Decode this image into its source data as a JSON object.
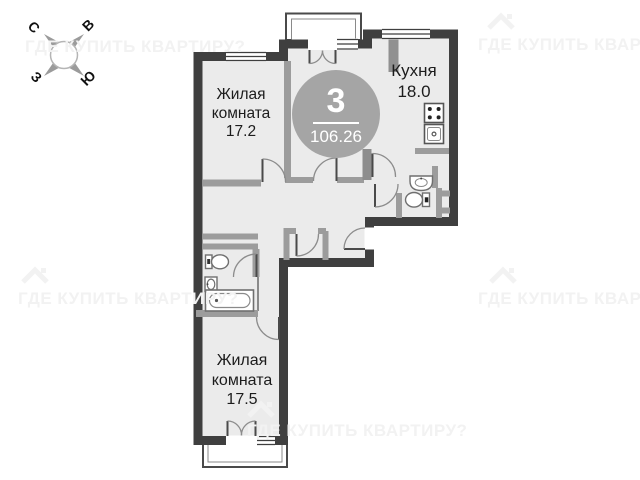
{
  "floorplan": {
    "badge": {
      "rooms_count": "3",
      "total_area": "106.26"
    },
    "compass": {
      "north": "С",
      "east": "В",
      "west": "З",
      "south": "Ю"
    },
    "rooms": {
      "living1": {
        "lines": [
          "Жилая",
          "комната",
          "17.2"
        ]
      },
      "kitchen": {
        "lines": [
          "Кухня",
          "18.0"
        ]
      },
      "living2": {
        "lines": [
          "Жилая",
          "комната",
          "17.5"
        ]
      }
    },
    "watermark_text": "ГДЕ КУПИТЬ КВАРТИРУ?",
    "icons": [
      "compass-rose-icon",
      "house-watermark-icon",
      "bathtub-icon",
      "toilet-icon",
      "washbasin-icon",
      "stove-icon",
      "kitchen-sink-icon",
      "window",
      "door-arc"
    ],
    "colors": {
      "wall": "#3f3f3f",
      "partition": "#9c9c9c",
      "room_fill": "#ebebeb",
      "badge_circle": "#a5a5a5",
      "watermark": "#f2f2f2",
      "label_text": "#1c1c1c"
    }
  }
}
